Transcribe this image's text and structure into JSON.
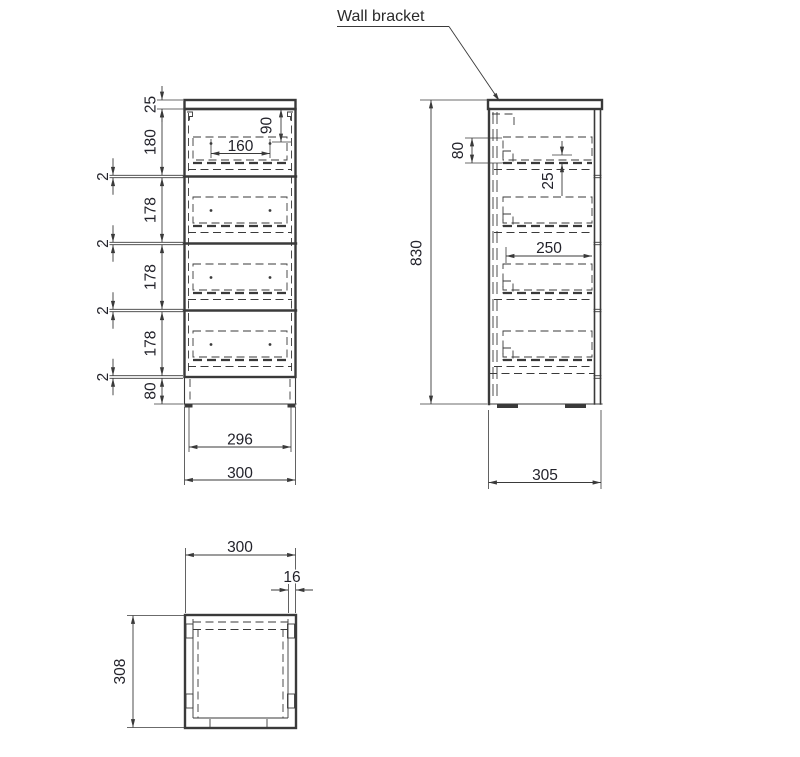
{
  "colors": {
    "line": "#3a3a3a",
    "dim_text": "#23232b",
    "label_text": "#2a2a2a",
    "background": "#ffffff"
  },
  "annotations": {
    "wall_bracket": "Wall bracket"
  },
  "front_view": {
    "chain": [
      "25",
      "180",
      "2",
      "178",
      "2",
      "178",
      "2",
      "178",
      "2",
      "80"
    ],
    "screw_spacing": "160",
    "screw_drop": "90",
    "inner_width": "296",
    "width": "300"
  },
  "side_view": {
    "box_height": "80",
    "screw_offset": "25",
    "drawer_depth": "250",
    "height": "830",
    "depth": "305"
  },
  "top_view": {
    "width": "300",
    "wall_thickness": "16",
    "depth": "308"
  }
}
